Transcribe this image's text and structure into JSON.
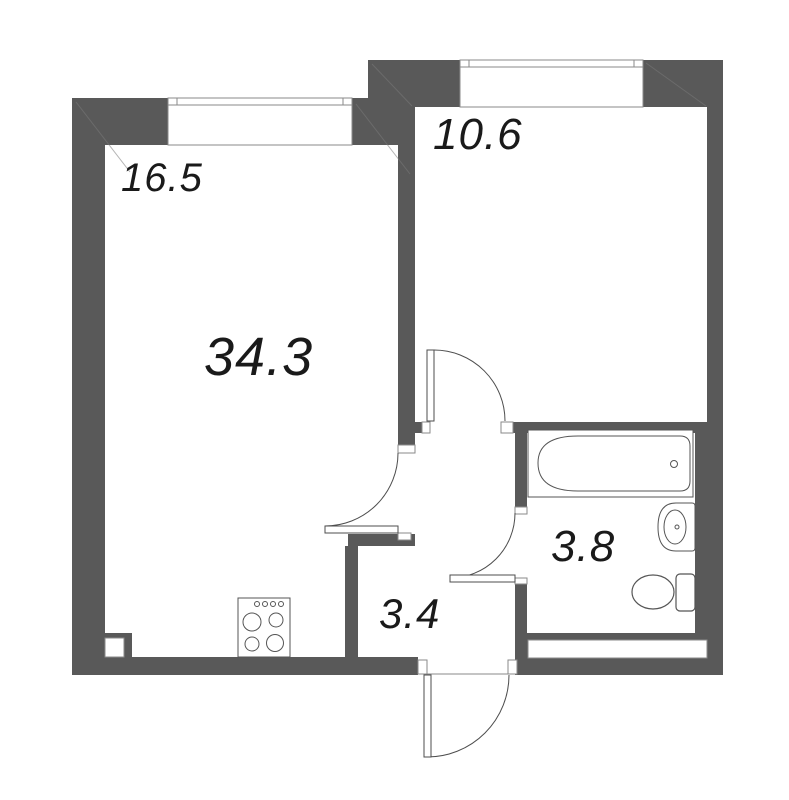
{
  "title": "1-room apartment floor plan",
  "areas": {
    "total": "34.3",
    "living_room": "16.5",
    "bedroom": "10.6",
    "bathroom": "3.8",
    "hallway": "3.4"
  },
  "colors": {
    "wall": "#595959",
    "outline": "#4d4d4d",
    "thin_line": "#8a8a8a",
    "fixture_line": "#555555",
    "label": "#1a1a1a",
    "bg": "#ffffff"
  },
  "fixtures": {
    "bathtub": "bathtub",
    "sink": "sink",
    "toilet": "toilet",
    "stove": "stove",
    "window_count": 2,
    "door_count": 4,
    "vent_shaft": "vent-shaft"
  }
}
